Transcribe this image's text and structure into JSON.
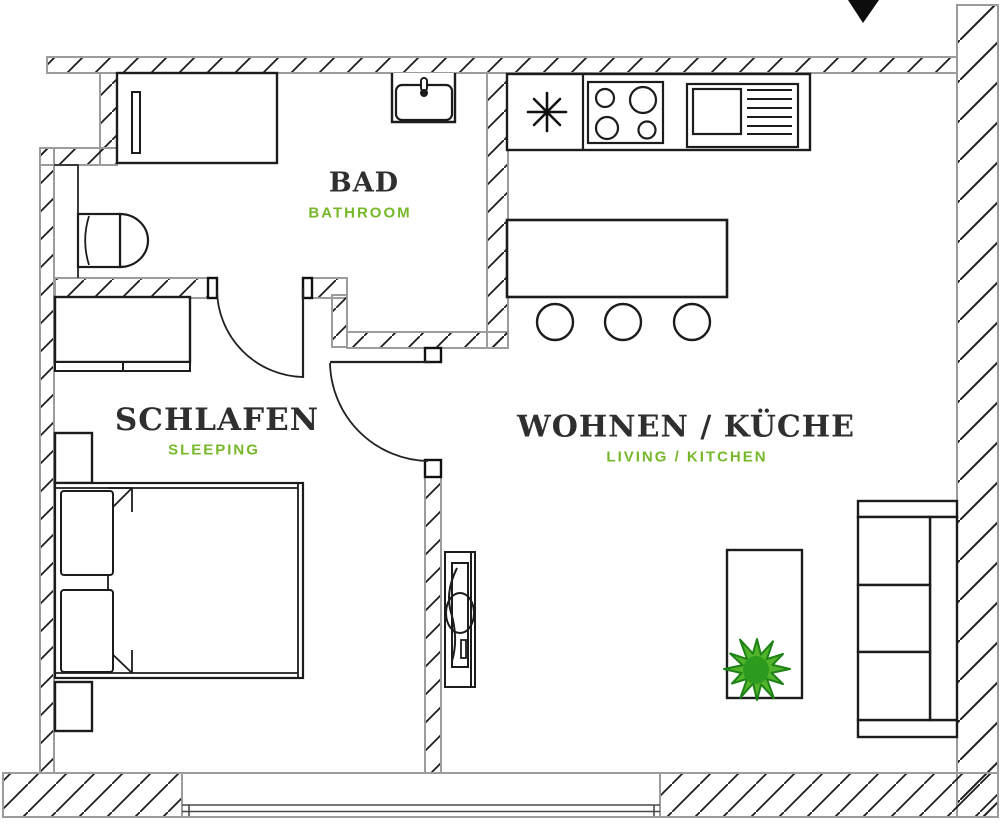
{
  "rooms": [
    {
      "id": "bathroom",
      "name": "BAD",
      "subtitle": "BATHROOM"
    },
    {
      "id": "bedroom",
      "name": "SCHLAFEN",
      "subtitle": "SLEEPING"
    },
    {
      "id": "living",
      "name": "WOHNEN / KÜCHE",
      "subtitle": "LIVING / KITCHEN"
    }
  ],
  "icons": {
    "entrance": "triangle-down-arrow",
    "kitchen_sink": "asterisk-star"
  },
  "colors": {
    "label_primary": "#2f2f2f",
    "label_secondary_green": "#76b82a",
    "wall_outline_gray": "#9c9c9c",
    "hatch_line": "#1c1c1c",
    "furniture_line": "#1c1c1c",
    "plant_leaf_fill": "#52b42a",
    "plant_leaf_stroke": "#1e8216",
    "plant_center": "#2d9b1d",
    "entrance_arrow": "#0d0d0d"
  }
}
